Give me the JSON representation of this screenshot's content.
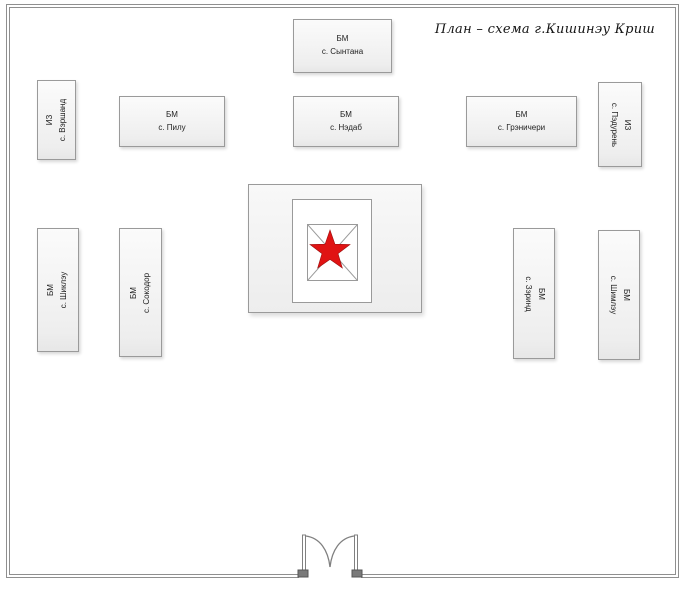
{
  "title": "План – схема  г.Кишинэу Криш",
  "boxes": [
    {
      "id": "santana",
      "line1": "БМ",
      "line2": "с. Сынтана"
    },
    {
      "id": "varsand",
      "line1": "ИЗ",
      "line2": "с. Вэршанд"
    },
    {
      "id": "pilu",
      "line1": "БМ",
      "line2": "с. Пилу"
    },
    {
      "id": "nadab",
      "line1": "БМ",
      "line2": "с. Нэдаб"
    },
    {
      "id": "graniceri",
      "line1": "БМ",
      "line2": "с. Грэничери"
    },
    {
      "id": "padureni",
      "line1": "ИЗ",
      "line2": "с. Пэдурень"
    },
    {
      "id": "siclau",
      "line1": "БМ",
      "line2": "с. Шиклэу"
    },
    {
      "id": "socodor",
      "line1": "БМ",
      "line2": "с. Сокодор"
    },
    {
      "id": "zerind",
      "line1": "БМ",
      "line2": "с. Зэринд"
    },
    {
      "id": "simlau",
      "line1": "БМ",
      "line2": "с. Шимлэу"
    }
  ],
  "icons": {
    "center_marker": "red-star",
    "entrance": "double-door"
  },
  "colors": {
    "star_red": "#e01313",
    "star_red_edge": "#9b0f0f",
    "shape_border": "#9a9a9a",
    "frame_gray": "#8f8f8f",
    "shape_fill": "#f2f2f2"
  }
}
